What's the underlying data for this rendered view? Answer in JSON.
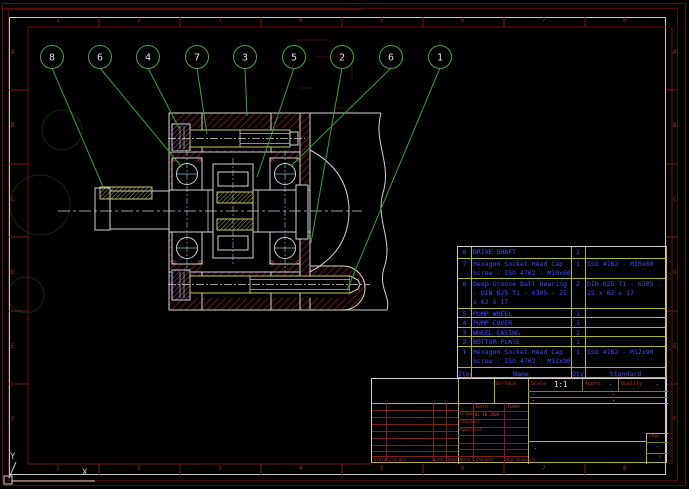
{
  "zones": {
    "top": [
      "1",
      "2",
      "3",
      "4",
      "5",
      "6",
      "7",
      "8"
    ],
    "bottom": [
      "1",
      "2",
      "3",
      "4",
      "5",
      "6",
      "7",
      "8"
    ],
    "left": [
      "A",
      "B",
      "C",
      "D",
      "E",
      "F"
    ],
    "right": [
      "A",
      "B",
      "C",
      "D",
      "E",
      "F"
    ]
  },
  "ucs": {
    "x": "X",
    "y": "Y"
  },
  "drawing": {
    "balloons": [
      "8",
      "6",
      "4",
      "7",
      "3",
      "5",
      "2",
      "6",
      "1"
    ]
  },
  "parts_list": {
    "headers": {
      "item": "Item",
      "name": "Name",
      "qty": "Qty",
      "standard": "Standard"
    },
    "rows": [
      {
        "item": "8",
        "name": "DRIVE SHAFT",
        "qty": "1",
        "standard": ""
      },
      {
        "item": "7",
        "name": "Hexagon Socket Head Cap Screw - ISO 4762 - M10x60",
        "qty": "1",
        "standard": "ISO 4762 - M10x60"
      },
      {
        "item": "6",
        "name": "Deep Groove Ball Bearing - DIN 625 T1 - 6305 - 25 x 62 x 17",
        "qty": "2",
        "standard": "DIN 625 T1 - 6305 - 25 x 62 x 17"
      },
      {
        "item": "5",
        "name": "PUMP WHEEL",
        "qty": "1",
        "standard": ""
      },
      {
        "item": "4",
        "name": "PUMP COVER",
        "qty": "1",
        "standard": ""
      },
      {
        "item": "3",
        "name": "WHEEL CASING",
        "qty": "1",
        "standard": ""
      },
      {
        "item": "2",
        "name": "BOTTOM PLATE",
        "qty": "1",
        "standard": ""
      },
      {
        "item": "1",
        "name": "Hexagon Socket Head Cap Screw - ISO 4762 - M12x90",
        "qty": "1",
        "standard": "ISO 4762 - M12x90"
      }
    ]
  },
  "title_block": {
    "surface_label": "Surface",
    "scale_label": "Scale",
    "scale_value": "1:1",
    "approved_label": "Appro.",
    "approved_value": "-",
    "quality_label": "Quality",
    "quality_value": "-",
    "dash_row2_left": "-",
    "dash_row2_right": "-",
    "dash_row3_left": "-",
    "dash_row3_right": "-",
    "date_header": "Date",
    "name_header": "Name",
    "drawn_label": "Drawn",
    "drawn_date": "01.10.2006",
    "checked_label": "Checked",
    "signed_label": "Approved",
    "title_value": "-",
    "page_label": "Page",
    "page_value": "-",
    "page_small": "P.",
    "rev_label": "State",
    "changes_label": "Changes",
    "rev_date_label": "Date",
    "rev_name_label": "Name",
    "norm_label": "Norm.",
    "norm_checked_label": "Checked",
    "app_standard_label": "App Standard"
  },
  "colors": {
    "hatch_red": "#7d1d1d",
    "outline_white": "#d4d4d4",
    "leader_green": "#3f9e3f",
    "bom_text_blue": "#4747ff",
    "grid_yellow": "#b5b535"
  }
}
